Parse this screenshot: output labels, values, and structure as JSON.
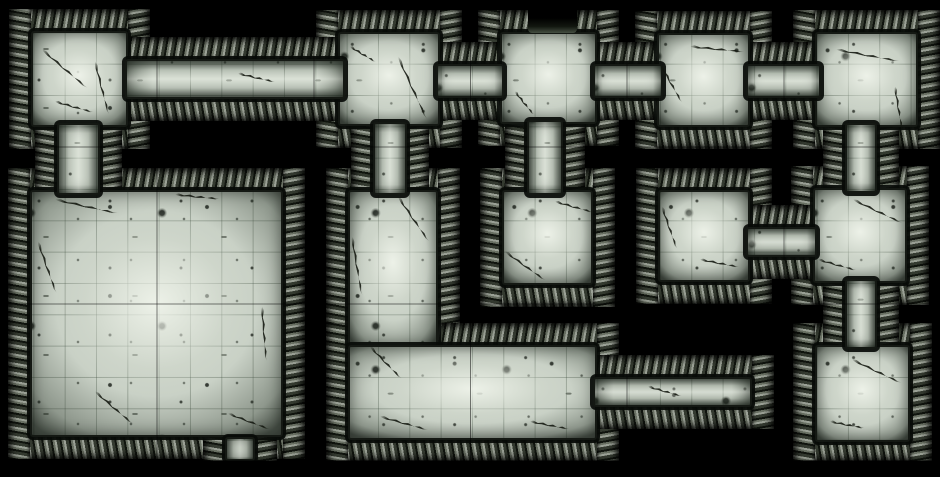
{
  "map": {
    "width": 940,
    "height": 477,
    "content_bottom": 461,
    "wall_thickness": 22,
    "background": "#000000",
    "grid": {
      "cell": 31.33,
      "major_every": 5,
      "major_spacing": 156.67,
      "line_color": "rgba(58,74,58,0.33)",
      "major_line_color": "rgba(0,0,0,0.5)"
    },
    "palette": {
      "floor_base": "#c9d1c6",
      "floor_bright": "#eff3e9",
      "floor_dim": "#6f7a6e",
      "wall_dark": "#10140e",
      "wall_mid": "#697063",
      "wall_light": "#9ba196",
      "wall_deep": "#343a30",
      "wall_under": "#161a14",
      "floor_edge": "#141813",
      "crack": "#11150d",
      "doorway_dark": "#000000",
      "doorway_inner": "#454e42"
    },
    "floors": [
      {
        "id": "room-top-1",
        "kind": "room",
        "x": 31,
        "y": 31,
        "w": 97,
        "h": 96
      },
      {
        "id": "room-top-2",
        "kind": "room",
        "x": 338,
        "y": 32,
        "w": 102,
        "h": 94
      },
      {
        "id": "room-top-3",
        "kind": "room",
        "x": 500,
        "y": 32,
        "w": 97,
        "h": 92
      },
      {
        "id": "room-top-4",
        "kind": "room",
        "x": 657,
        "y": 33,
        "w": 93,
        "h": 94
      },
      {
        "id": "room-top-5",
        "kind": "room",
        "x": 815,
        "y": 32,
        "w": 103,
        "h": 95
      },
      {
        "id": "great-hall",
        "kind": "room",
        "x": 30,
        "y": 190,
        "w": 253,
        "h": 247
      },
      {
        "id": "l-hall-vertical",
        "kind": "room",
        "x": 348,
        "y": 190,
        "w": 90,
        "h": 157
      },
      {
        "id": "l-hall-horizontal",
        "kind": "room",
        "x": 348,
        "y": 345,
        "w": 249,
        "h": 95
      },
      {
        "id": "room-mid-1",
        "kind": "room",
        "x": 502,
        "y": 190,
        "w": 91,
        "h": 95
      },
      {
        "id": "room-mid-2",
        "kind": "room",
        "x": 658,
        "y": 190,
        "w": 92,
        "h": 92
      },
      {
        "id": "room-right-middle",
        "kind": "room",
        "x": 813,
        "y": 188,
        "w": 94,
        "h": 95
      },
      {
        "id": "room-right-bottom",
        "kind": "room",
        "x": 815,
        "y": 345,
        "w": 95,
        "h": 97
      },
      {
        "id": "corridor-west",
        "kind": "ch",
        "x": 125,
        "y": 59,
        "w": 220,
        "h": 40
      },
      {
        "id": "corridor-r2-r3",
        "kind": "ch",
        "x": 436,
        "y": 64,
        "w": 68,
        "h": 34
      },
      {
        "id": "corridor-r3-r4",
        "kind": "ch",
        "x": 593,
        "y": 64,
        "w": 70,
        "h": 34
      },
      {
        "id": "corridor-r4-r5",
        "kind": "ch",
        "x": 746,
        "y": 64,
        "w": 75,
        "h": 34
      },
      {
        "id": "corridor-r1-south",
        "kind": "cv",
        "x": 57,
        "y": 123,
        "w": 43,
        "h": 72
      },
      {
        "id": "corridor-r2-south",
        "kind": "cv",
        "x": 373,
        "y": 122,
        "w": 34,
        "h": 73
      },
      {
        "id": "corridor-r3-south",
        "kind": "cv",
        "x": 527,
        "y": 120,
        "w": 36,
        "h": 75
      },
      {
        "id": "corridor-r5-south",
        "kind": "cv",
        "x": 845,
        "y": 123,
        "w": 32,
        "h": 70
      },
      {
        "id": "corridor-m2-east",
        "kind": "ch",
        "x": 746,
        "y": 227,
        "w": 71,
        "h": 30
      },
      {
        "id": "corridor-right-mid",
        "kind": "cv",
        "x": 845,
        "y": 279,
        "w": 32,
        "h": 70
      },
      {
        "id": "corridor-deadend",
        "kind": "ch",
        "x": 593,
        "y": 377,
        "w": 159,
        "h": 30
      },
      {
        "id": "hall-south-stub",
        "kind": "cv",
        "x": 225,
        "y": 437,
        "w": 30,
        "h": 24
      }
    ],
    "openings": [
      {
        "id": "north-doorway",
        "x": 528,
        "y": 0,
        "w": 49,
        "h": 33
      }
    ],
    "cracks": [
      [
        42,
        48,
        60,
        40
      ],
      [
        95,
        60,
        55,
        75
      ],
      [
        55,
        100,
        40,
        15
      ],
      [
        238,
        72,
        38,
        12
      ],
      [
        398,
        55,
        70,
        65
      ],
      [
        350,
        45,
        30,
        30
      ],
      [
        515,
        90,
        30,
        50
      ],
      [
        690,
        45,
        55,
        5
      ],
      [
        660,
        62,
        45,
        60
      ],
      [
        836,
        48,
        65,
        10
      ],
      [
        895,
        85,
        45,
        80
      ],
      [
        55,
        198,
        65,
        12
      ],
      [
        38,
        240,
        55,
        70
      ],
      [
        175,
        193,
        45,
        5
      ],
      [
        262,
        305,
        55,
        85
      ],
      [
        95,
        390,
        50,
        40
      ],
      [
        228,
        412,
        45,
        20
      ],
      [
        398,
        195,
        55,
        55
      ],
      [
        352,
        235,
        60,
        80
      ],
      [
        370,
        345,
        45,
        45
      ],
      [
        380,
        415,
        50,
        15
      ],
      [
        530,
        420,
        40,
        10
      ],
      [
        505,
        250,
        50,
        35
      ],
      [
        555,
        200,
        40,
        15
      ],
      [
        662,
        205,
        45,
        70
      ],
      [
        700,
        258,
        40,
        10
      ],
      [
        853,
        198,
        55,
        25
      ],
      [
        818,
        258,
        40,
        15
      ],
      [
        852,
        358,
        55,
        25
      ],
      [
        830,
        420,
        35,
        10
      ],
      [
        648,
        385,
        35,
        15
      ]
    ]
  }
}
